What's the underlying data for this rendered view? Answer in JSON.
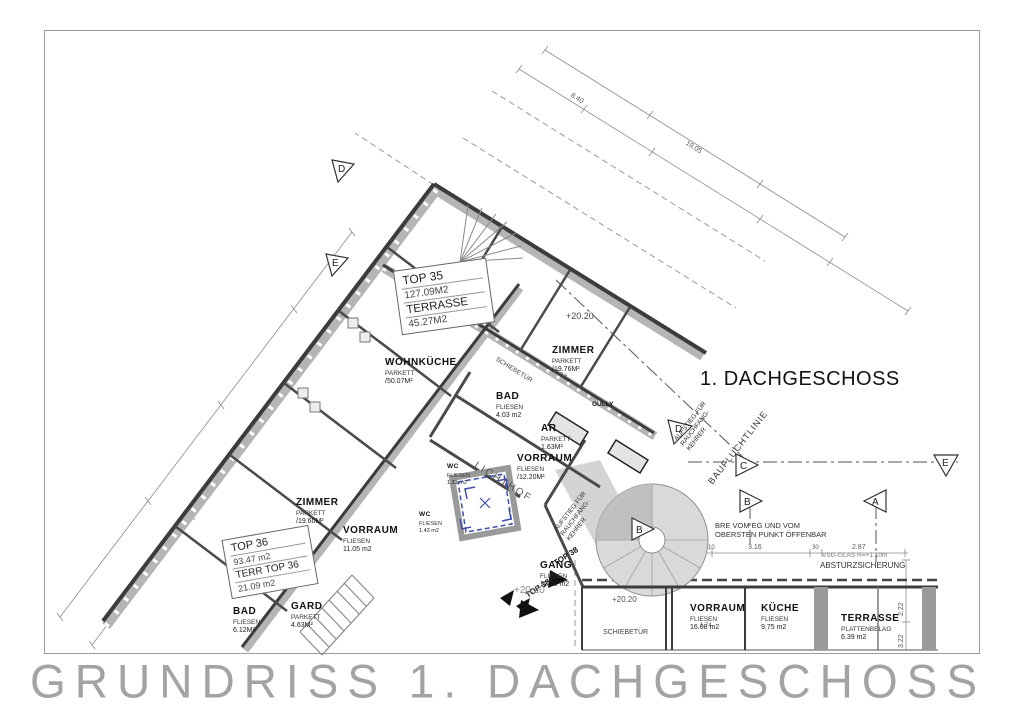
{
  "title_block": {
    "title": "GRUNDRISS 1. DACHGESCHOSS"
  },
  "floor_label": "1. DACHGESCHOSS",
  "apartments": [
    {
      "name": "TOP 35",
      "area": "127.09M2",
      "sub": "TERRASSE",
      "sub_area": "45.27M2"
    },
    {
      "name": "TOP 36",
      "area": "93.47 m2",
      "sub": "TERR TOP 36",
      "sub_area": "21.09 m2"
    }
  ],
  "rooms": [
    {
      "name": "ZIMMER",
      "finish": "PARKETT",
      "area": "/19.76M²"
    },
    {
      "name": "WOHNKÜCHE",
      "finish": "PARKETT",
      "area": "/50.07M²"
    },
    {
      "name": "BAD",
      "finish": "FLIESEN",
      "area": "4.03 m2"
    },
    {
      "name": "AR",
      "finish": "PARKETT",
      "area": "1.63M²"
    },
    {
      "name": "VORRAUM",
      "finish": "FLIESEN",
      "area": "/12.20M²"
    },
    {
      "name": "WC",
      "finish": "FLIESEN",
      "area": "1.31 m2"
    },
    {
      "name": "WC",
      "finish": "FLIESEN",
      "area": "1.43 m2"
    },
    {
      "name": "ZIMMER",
      "finish": "PARKETT",
      "area": "/19.60M²"
    },
    {
      "name": "VORRAUM",
      "finish": "FLIESEN",
      "area": "11.05 m2"
    },
    {
      "name": "BAD",
      "finish": "FLIESEN",
      "area": "6.12M²"
    },
    {
      "name": "GARD",
      "finish": "PARKETT",
      "area": "4.63M²"
    },
    {
      "name": "GANG",
      "finish": "FLIESEN",
      "area": "12.28 m2"
    },
    {
      "name": "VORRAUM",
      "finish": "FLIESEN",
      "area": "16.08 m2"
    },
    {
      "name": "KÜCHE",
      "finish": "FLIESEN",
      "area": "9.75 m2"
    },
    {
      "name": "TERRASSE",
      "finish": "PLATTENBELAG",
      "area": "6.39 m2"
    },
    {
      "name": "LICHTHOF"
    }
  ],
  "misc": {
    "gully": "GULLY",
    "schiebetuer": "SCHIEBETÜR",
    "top38": "TOP 38",
    "aufstieg_l1": "AUFSTIEG FÜR",
    "aufstieg_l2": "RAUCHFANG-",
    "aufstieg_l3": "KEHRER",
    "bauflucht": "BAUFLUCHTLINIE",
    "note_l1": "BRE VOM EG UND VOM",
    "note_l2": "OBERSTEN PUNKT ÖFFENBAR",
    "vsg": "VSG-GLAS H=+1.10m",
    "absturz": "ABSTURZSICHERUNG",
    "level": "+20.20"
  },
  "markers": [
    {
      "letter": "D"
    },
    {
      "letter": "E"
    },
    {
      "letter": "D"
    },
    {
      "letter": "C"
    },
    {
      "letter": "B"
    },
    {
      "letter": "B"
    },
    {
      "letter": "A"
    },
    {
      "letter": "E"
    }
  ],
  "dims": [
    "8.40",
    "19.05",
    "2.97",
    "3.16",
    "2.87",
    "10",
    "30",
    "1.74",
    "2.22",
    "3.22"
  ],
  "colors": {
    "wall_dark": "#3c3c3c",
    "wall_gray": "#b5b5b5",
    "lichthof_blue": "#3f4fae",
    "title_gray": "#a3a3a3"
  }
}
